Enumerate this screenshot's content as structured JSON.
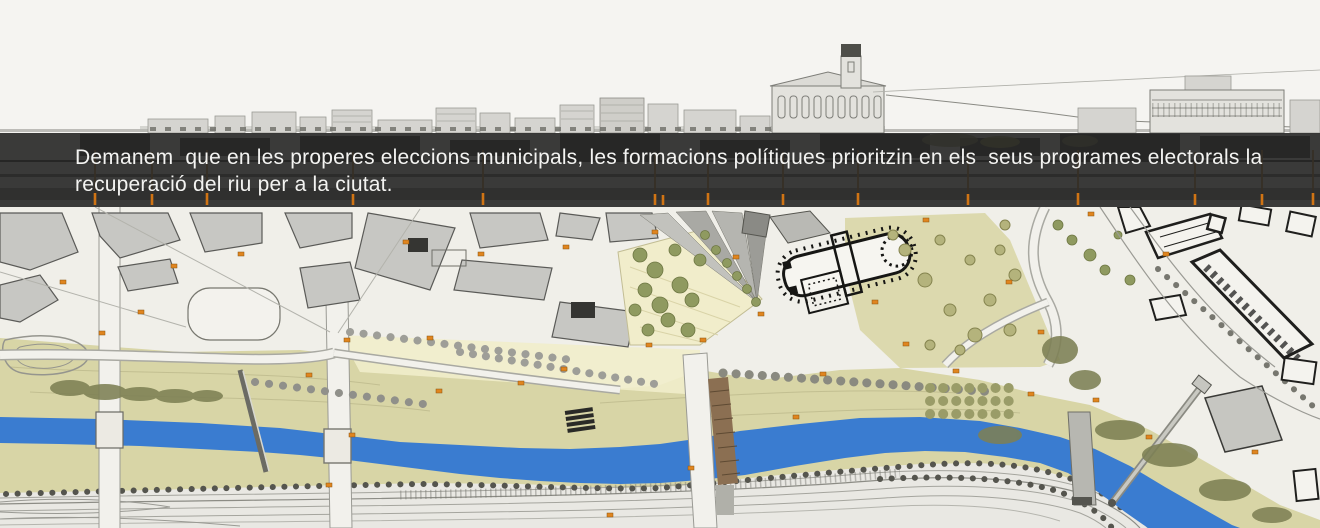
{
  "banner": {
    "lines": [
      "Demanem  que en les properes eleccions municipals, les formacions polítiques prioritzin en els  seus programes electorals la",
      "recuperació del riu per a la ciutat."
    ]
  },
  "palette": {
    "paper": "#f5f4f1",
    "plan": "#f0efe9",
    "flood": "#d8d5a6",
    "flood2": "#dcd9ae",
    "esplanade": "#f1edcb",
    "river": "#3a7cd0",
    "corridor": "#e9e8e3",
    "park": "#8f9a60",
    "olive": "#b4b37c",
    "oliveDark": "#7d8054",
    "treeGray": "#9e9e98",
    "blockGray": "#c7c7c3",
    "blockDark": "#353532",
    "inkBlack": "#1f1f1d",
    "lineGray": "#9a9a94",
    "orange": "#e0851f",
    "brown": "#8b6f52",
    "bannerBg": "rgba(40,40,38,0.91)",
    "bannerText": "#f3f3f1"
  }
}
